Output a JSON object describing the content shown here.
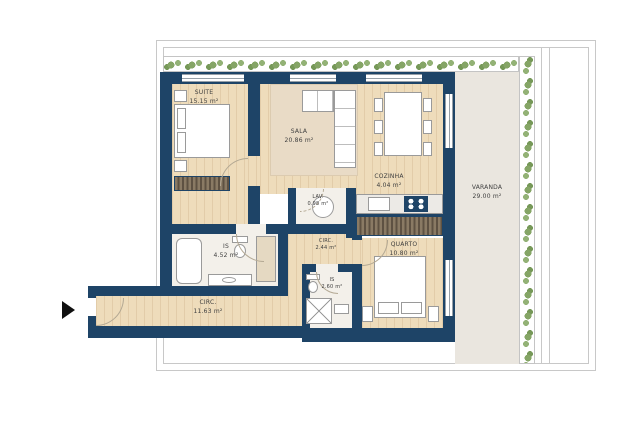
{
  "plan": {
    "type": "apartment-floor-plan",
    "rooms": [
      {
        "name": "SUITE",
        "area": "15.15 m²"
      },
      {
        "name": "SALA",
        "area": "20.86 m²"
      },
      {
        "name": "COZINHA",
        "area": "4.04 m²"
      },
      {
        "name": "LAV.",
        "area": "0.98 m²"
      },
      {
        "name": "IS",
        "area": "4.52 m²"
      },
      {
        "name": "CIRC.",
        "area": "2.44 m²"
      },
      {
        "name": "IS",
        "area": "2.60 m²"
      },
      {
        "name": "QUARTO",
        "area": "10.80 m²"
      },
      {
        "name": "CIRC.",
        "area": "11.63 m²"
      },
      {
        "name": "VARANDA",
        "area": "29.00 m²"
      }
    ],
    "colors": {
      "wall": "#1e4467",
      "wood_floor": "#eedcbb",
      "tile_floor": "#f3f0ea",
      "varanda_floor": "#eae6df",
      "rug": "#e9dbc6",
      "plants": "#85a566",
      "wardrobe": "#6e5f4e",
      "outline": "#c8c8c8",
      "entrance_arrow": "#101010"
    }
  }
}
